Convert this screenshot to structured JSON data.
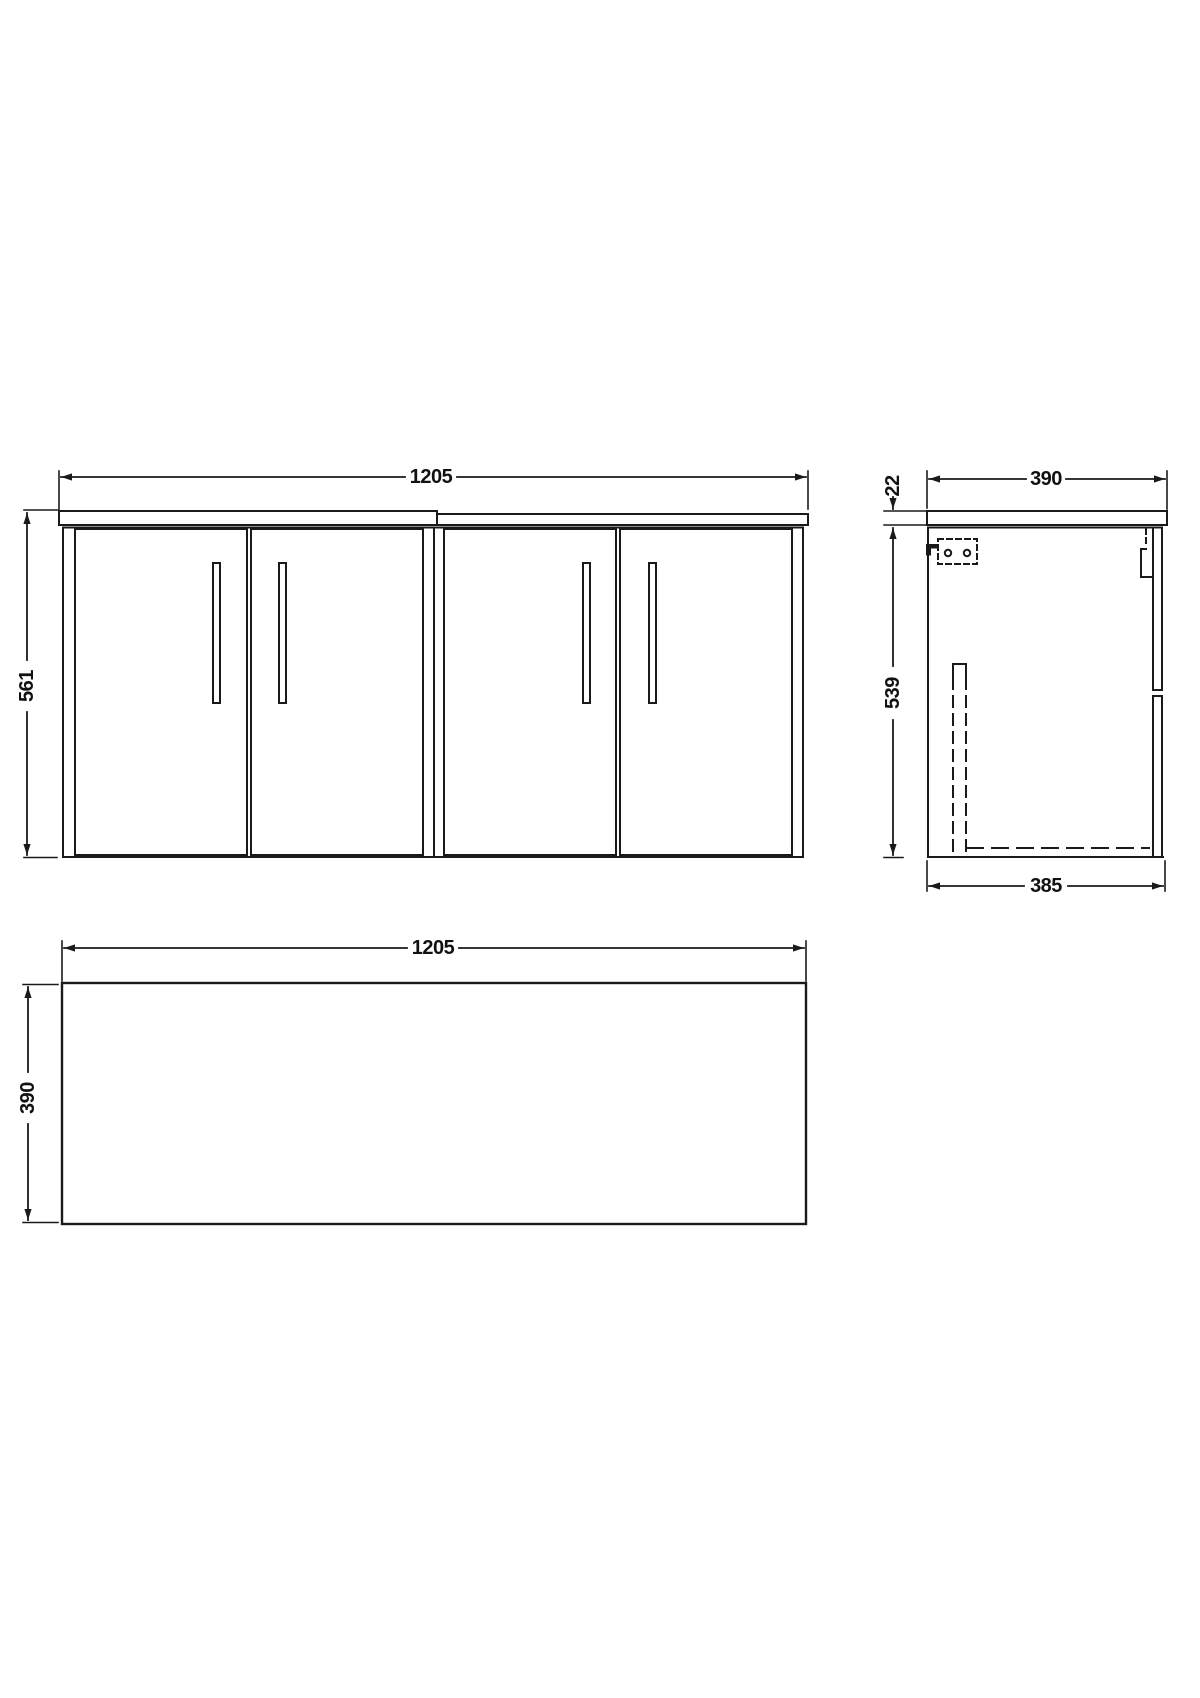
{
  "drawing": {
    "colors": {
      "line": "#1a1a1a",
      "background": "#ffffff"
    },
    "views": {
      "front": {
        "dims": {
          "width": "1205",
          "height": "561"
        }
      },
      "side": {
        "dims": {
          "depth_overall": "390",
          "worktop_thickness": "22",
          "cabinet_height": "539",
          "cabinet_depth": "385"
        }
      },
      "plan": {
        "dims": {
          "width": "1205",
          "depth": "390"
        }
      }
    }
  }
}
